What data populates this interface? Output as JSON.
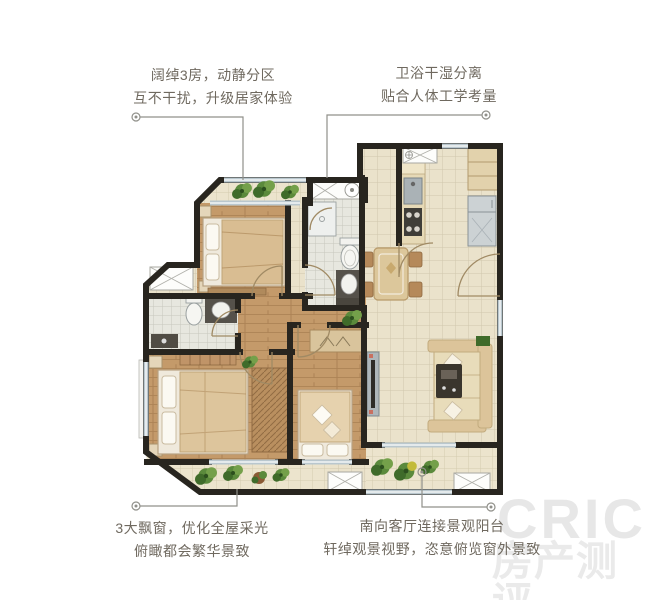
{
  "annotations": [
    {
      "id": "top-left",
      "line1": "阔绰3房，动静分区",
      "line2": "互不干扰，升级居家体验"
    },
    {
      "id": "top-right",
      "line1": "卫浴干湿分离",
      "line2": "贴合人体工学考量"
    },
    {
      "id": "bottom-left",
      "line1": "3大飘窗，优化全屋采光",
      "line2": "俯瞰都会繁华景致"
    },
    {
      "id": "bottom-right",
      "line1": "南向客厅连接景观阳台",
      "line2": "轩绰观景视野，恣意俯览窗外景致"
    }
  ],
  "watermark": {
    "brand": "CRIC",
    "subtitle": "房产测评"
  },
  "colors": {
    "wall": "#28251f",
    "wood": "#c49a6a",
    "tile": "#eae2cb",
    "bath": "#e7e7df",
    "balcony": "#ece4cd",
    "glass": "#b9c7ce",
    "counter_dark": "#55514a",
    "furn_tan": "#dcc49a",
    "plant": "#4e7c38",
    "text": "#6f695f",
    "leader": "#90908a",
    "watermark": "#e5e5e5"
  }
}
